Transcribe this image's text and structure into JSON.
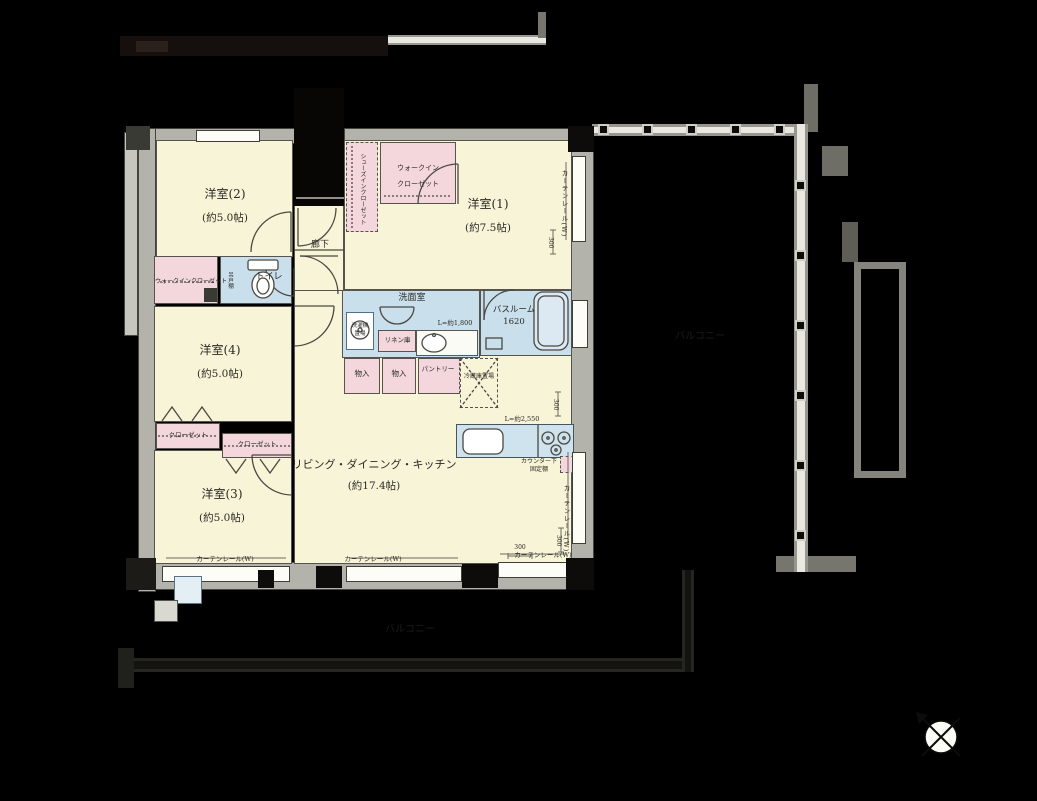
{
  "plan": {
    "rooms": {
      "bedroom1": {
        "name": "洋室(1)",
        "size": "(約7.5帖)"
      },
      "bedroom2": {
        "name": "洋室(2)",
        "size": "(約5.0帖)"
      },
      "bedroom3": {
        "name": "洋室(3)",
        "size": "(約5.0帖)"
      },
      "bedroom4": {
        "name": "洋室(4)",
        "size": "(約5.0帖)"
      },
      "ldk": {
        "name": "リビング・ダイニング・キッチン",
        "size": "(約17.4帖)"
      },
      "washroom": {
        "name": "洗面室"
      },
      "bathroom": {
        "name": "バスルーム",
        "size": "1620"
      },
      "toilet": {
        "name": "トイレ"
      },
      "hallway": {
        "name": "廊下"
      },
      "balcony_right": {
        "name": "バルコニー"
      },
      "balcony_bottom": {
        "name": "バルコニー"
      }
    },
    "storage": {
      "walk_in_closet_main_l1": "ウォークイン",
      "walk_in_closet_main_l2": "クローゼット",
      "shoes_in_closet": "シューズインクローゼット",
      "walk_in_closet_4": "ウォークインクローゼット",
      "closet_a": "クローゼット",
      "closet_b": "クローゼット",
      "storage_a": "物入",
      "storage_b": "物入",
      "pantry": "パントリー",
      "linen": "リネン庫",
      "washer_l1": "洗濯機",
      "washer_l2": "置場",
      "fridge": "冷蔵庫置場",
      "hanging_cabinet": "吊戸棚",
      "counter_shelf_l1": "カウンター下",
      "counter_shelf_l2": "固定棚"
    },
    "dimensions": {
      "vanity_length": "L=約1,800",
      "counter_length": "L=約2,550",
      "dim_300": "300"
    },
    "fixtures": {
      "curtain_rail": "カーテンレール(W)"
    },
    "icons": {
      "compass": "north-compass"
    },
    "colors": {
      "floor_cream": "#f8f4d8",
      "closet_pink": "#f3d7dd",
      "wet_area_blue": "#c9dfec",
      "wall_gray": "#b3b3ac"
    }
  }
}
